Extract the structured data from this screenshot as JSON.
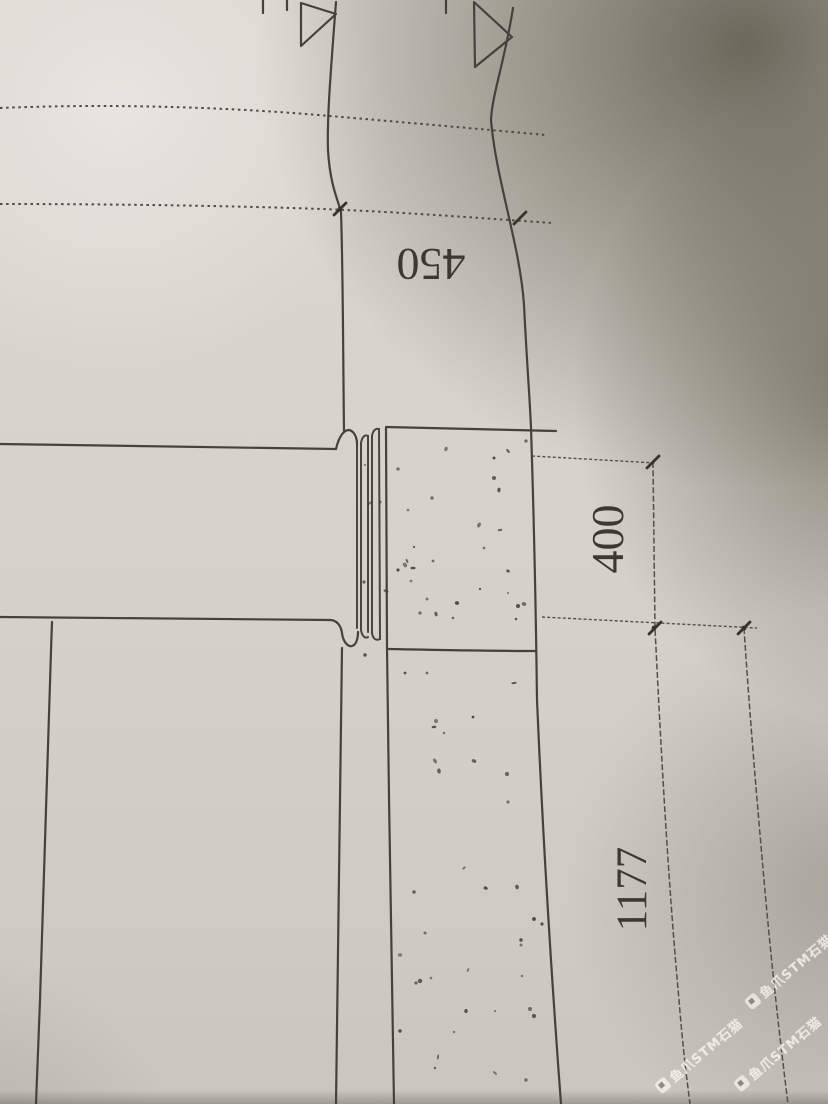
{
  "drawing": {
    "type": "technical-drawing-photo",
    "description": "photograph of a construction detail drawing, rotated 180 degrees",
    "ink_color": "#46413a",
    "paper_color": "#d7d3cc",
    "dimensions": [
      {
        "id": "dim-450",
        "label": "450",
        "orientation": "horizontal",
        "text_rotation_deg": 180
      },
      {
        "id": "dim-400",
        "label": "400",
        "orientation": "vertical",
        "text_rotation_deg": -90
      },
      {
        "id": "dim-1177",
        "label": "1177",
        "orientation": "vertical",
        "text_rotation_deg": -90
      }
    ],
    "symbols": [
      {
        "name": "section-marker-triangle",
        "count": 2
      }
    ],
    "hatching": "concrete-stipple"
  },
  "watermark": {
    "text": "鱼爪STM石猫",
    "color": "#ffffff"
  }
}
